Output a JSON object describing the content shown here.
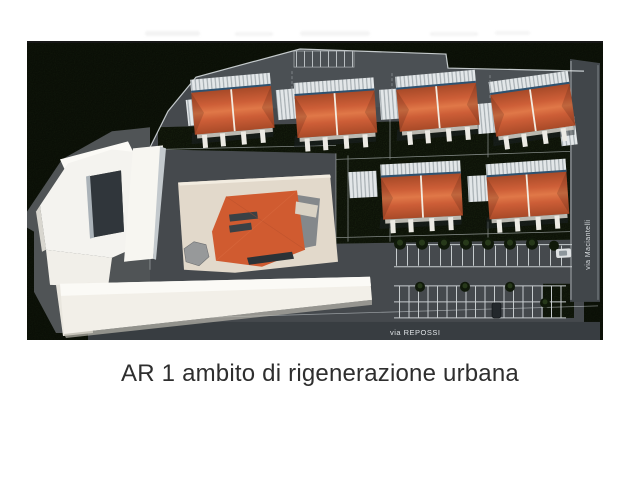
{
  "page": {
    "background_color": "#ffffff",
    "caption": "AR 1 ambito di rigenerazione urbana",
    "caption_color": "#2e2e2e"
  },
  "plan": {
    "street_labels": {
      "bottom": "via REPOSSI",
      "right": "via Maciantelli"
    },
    "site": {
      "orange_duplex_buildings": 6,
      "central_orange_building": 1,
      "white_existing_buildings": 3,
      "parking_rows": 3
    },
    "colors": {
      "forest_green": "#161f0e",
      "lawn_green": "#222f15",
      "asphalt": "#45494d",
      "asphalt_light": "#505456",
      "road_dark": "#383d41",
      "roof_orange": "#d05b30",
      "roof_orange_dark": "#b34e2b",
      "roof_ridge_white": "#f3ece1",
      "platform_cream": "#e2d9cb",
      "building_white": "#f4f2ec",
      "marking_white": "#dfe5e8",
      "courtyard_dark": "#30363b"
    }
  }
}
